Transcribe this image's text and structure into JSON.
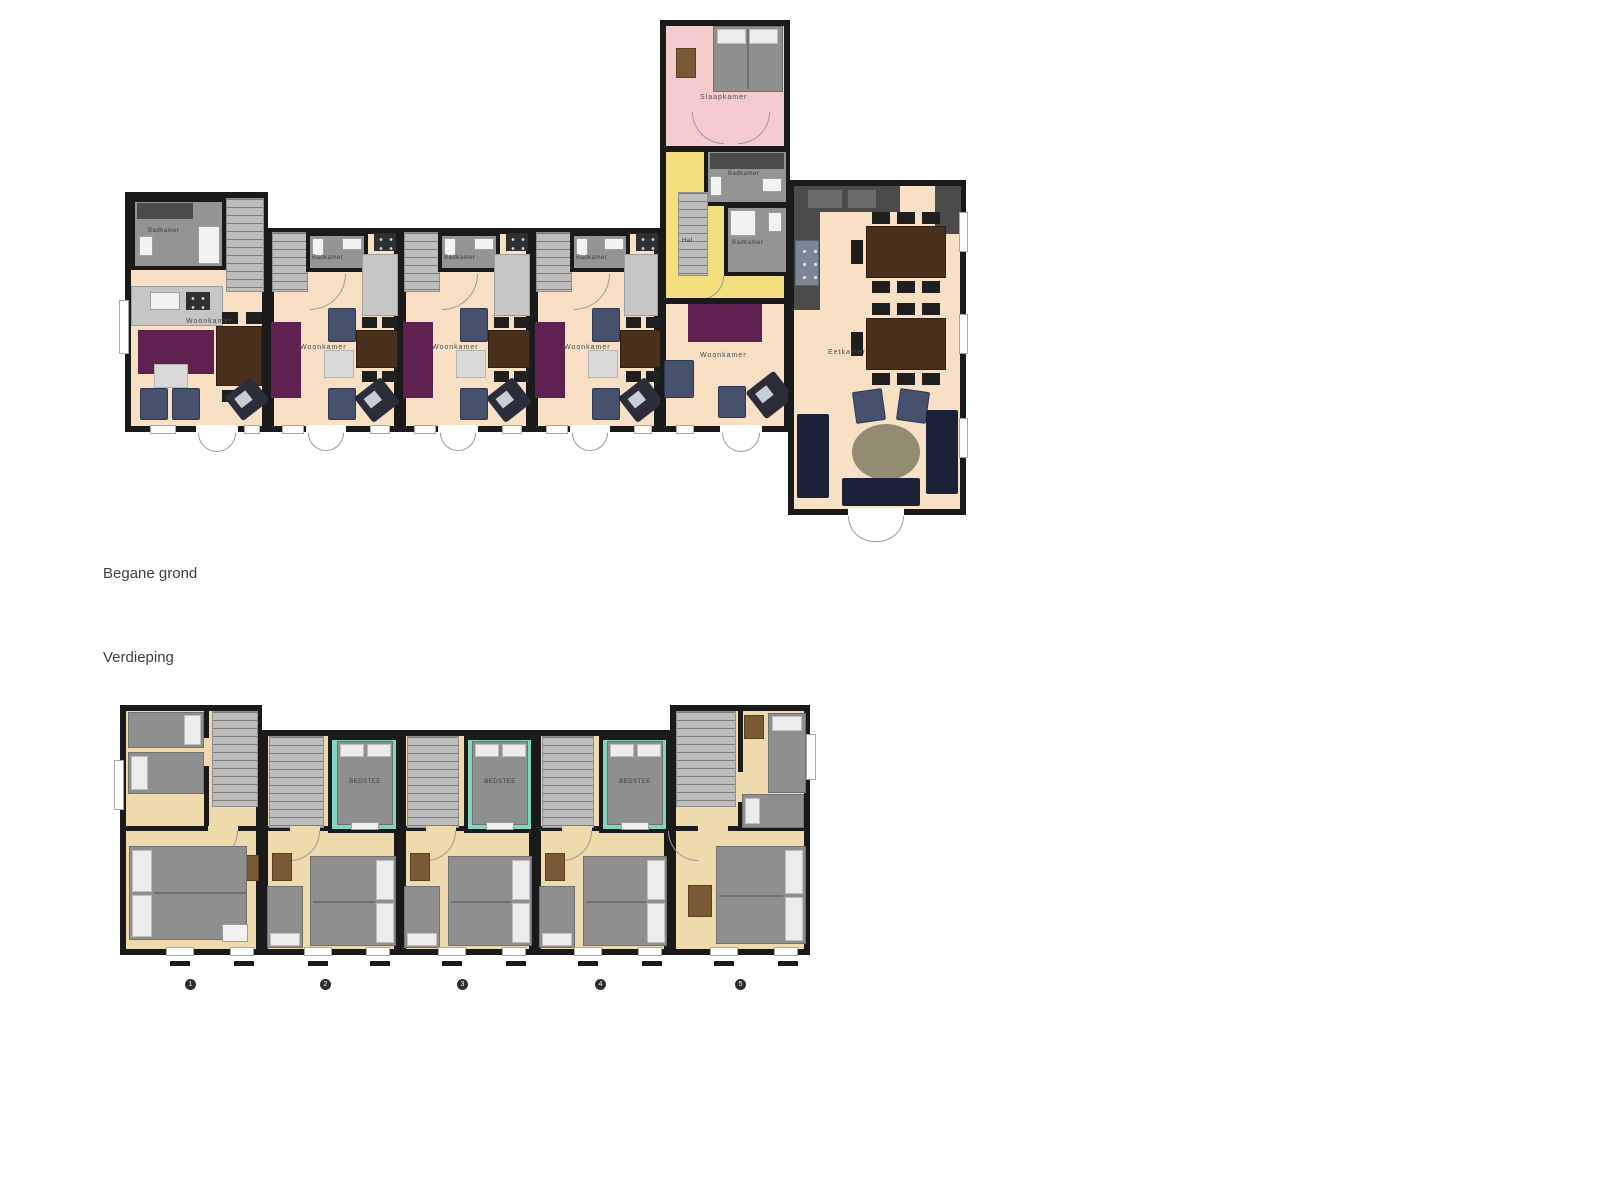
{
  "document": {
    "background": "#ffffff"
  },
  "sections": {
    "ground_floor": {
      "title": "Begane grond"
    },
    "upper_floor": {
      "title": "Verdieping",
      "unit_badges": [
        "1",
        "2",
        "3",
        "4",
        "5"
      ]
    }
  },
  "room_labels": {
    "slaapkamer": "Slaapkamer",
    "badkamer": "Badkamer",
    "hal": "Hal",
    "woonkamer": "Woonkamer",
    "eetkamer": "Eetkamer",
    "bedstee": "BEDSTEE"
  },
  "colors": {
    "page": "#ffffff",
    "wall": "#1a1a1a",
    "floor_ground": "#f9dfc4",
    "floor_upper": "#efdaad",
    "bedroom_pink": "#f6cbce",
    "hall_yellow": "#f3df7d",
    "bedstee_teal": "#7fd5bf",
    "bathroom_grey": "#949494",
    "sofa_purple": "#5e2150",
    "sofa_navy": "#1b2238",
    "chair_blue": "#46516d",
    "table_brown": "#4a2f1d",
    "rug_beige": "#948b73",
    "dresser_brown": "#7a5a36"
  }
}
